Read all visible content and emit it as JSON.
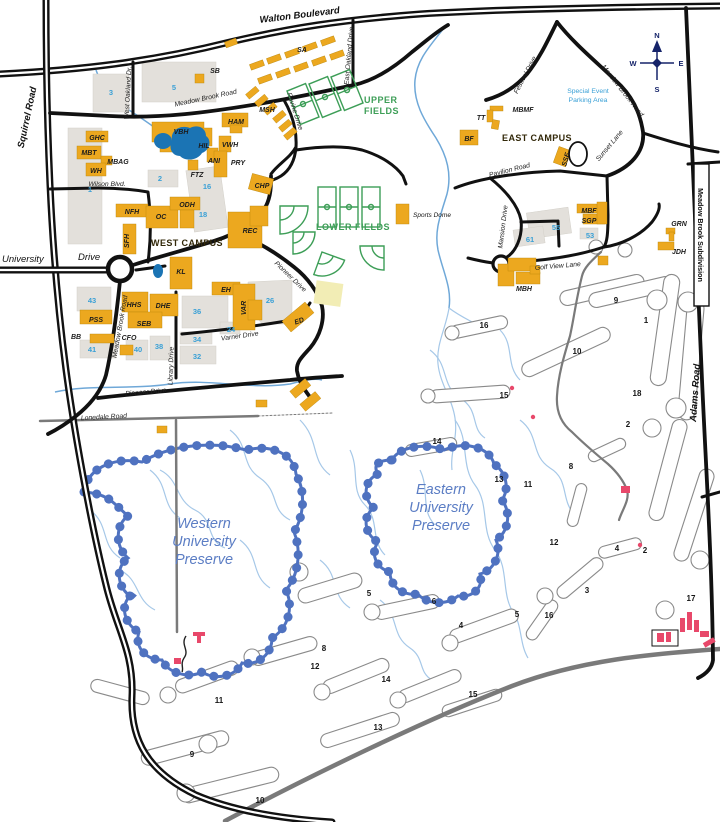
{
  "roads": {
    "walton": "Walton Boulevard",
    "squirrel": "Squirrel Road",
    "university": "University",
    "university_drive": "Drive",
    "meadow_brook_top": "Meadow Brook Road",
    "meadow_brook_east": "Meadow Brook Road",
    "meadow_brook_campus": "Meadow Brook Road",
    "west_oakland": "West Oakland Dr.",
    "east_oakland": "East Oakland Drive",
    "ravine": "Ravine Drive",
    "festival": "Festival Drive",
    "sunset": "Sunset Lane",
    "pavilion": "Pavilion Road",
    "mansion": "Mansion Drive",
    "golf_view": "Golf View Lane",
    "pioneer_upper": "Pioneer Drive",
    "pioneer_lower": "Pioneer Drive",
    "library": "Library Drive",
    "varner": "Varner Drive",
    "lonedale": "Lonedale Road",
    "adams": "Adams Road",
    "subdivision": "Meadow Brook Subdivision",
    "wilson": "Wilson Blvd."
  },
  "areas": {
    "west_campus": "WEST CAMPUS",
    "east_campus": "EAST CAMPUS",
    "upper_fields_1": "UPPER",
    "upper_fields_2": "FIELDS",
    "lower_fields": "LOWER FIELDS",
    "sports_dome": "Sports Dome",
    "special_event_1": "Special Event",
    "special_event_2": "Parking Area"
  },
  "preserves": {
    "western": [
      "Western",
      "University",
      "Preserve"
    ],
    "eastern": [
      "Eastern",
      "University",
      "Preserve"
    ]
  },
  "buildings": {
    "SA": "SA",
    "SB": "SB",
    "MSH": "MSH",
    "GHC": "GHC",
    "VBH": "VBH",
    "HAM": "HAM",
    "HIL": "HIL",
    "VWH": "VWH",
    "MBT": "MBT",
    "MBAG": "MBAG",
    "WH": "WH",
    "ANI": "ANI",
    "PRY": "PRY",
    "FTZ": "FTZ",
    "CHP": "CHP",
    "NFH": "NFH",
    "OC": "OC",
    "ODH": "ODH",
    "SFH": "SFH",
    "REC": "REC",
    "KL": "KL",
    "EH": "EH",
    "VAR": "VAR",
    "HHS": "HHS",
    "DHE": "DHE",
    "SEB": "SEB",
    "PSS": "PSS",
    "BB": "BB",
    "CFO": "CFO",
    "ED": "ED",
    "MBMF": "MBMF",
    "TT": "TT",
    "BF": "BF",
    "SSE": "SSE",
    "MBF": "MBF",
    "SGP": "SGP",
    "GRN": "GRN",
    "JDH": "JDH",
    "MBH": "MBH"
  },
  "parking_lots": {
    "p1": "1",
    "p2": "2",
    "p3": "3",
    "p5": "5",
    "p16": "16",
    "p18": "18",
    "p24": "24",
    "p26": "26",
    "p32": "32",
    "p34": "34",
    "p36": "36",
    "p38": "38",
    "p40": "40",
    "p41": "41",
    "p43": "43",
    "p53": "53",
    "p55": "55",
    "p61": "61"
  },
  "golf_holes": [
    "16",
    "10",
    "9",
    "1",
    "15",
    "18",
    "2",
    "14",
    "13",
    "8",
    "11",
    "12",
    "4",
    "2",
    "3",
    "17",
    "5",
    "16",
    "5",
    "6",
    "4",
    "8",
    "12",
    "14",
    "15",
    "11",
    "13",
    "9",
    "10"
  ],
  "compass": {
    "n": "N",
    "e": "E",
    "s": "S",
    "w": "W"
  },
  "colors": {
    "building_gold": "#ECA81F",
    "parking_lot_gray": "#E3E0DB",
    "parking_number_blue": "#3AA0D6",
    "field_green": "#3D9E57",
    "preserve_blue": "#5B7DC4",
    "creek_blue": "#A6C8E8",
    "pond_blue": "#1B74B4",
    "road_black": "#111111",
    "minor_road_gray": "#7A7A7A",
    "highlight_pink": "#E8486A"
  }
}
